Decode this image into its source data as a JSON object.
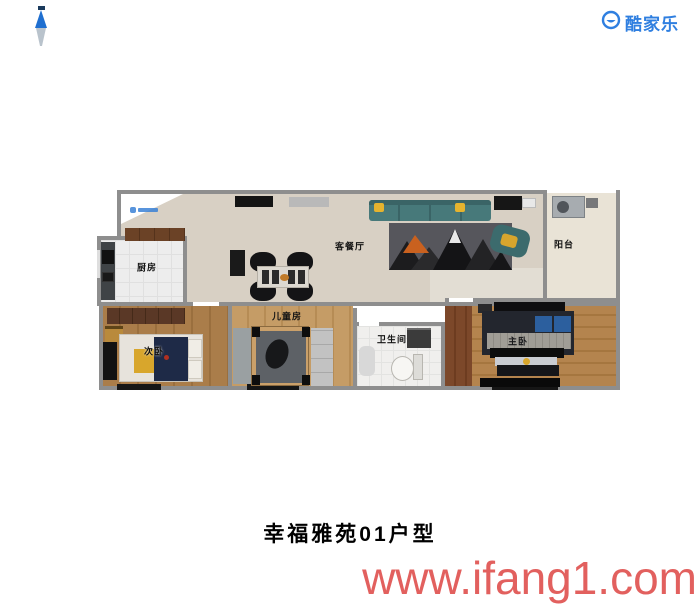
{
  "header": {
    "compass_icon": "north-compass",
    "logo": {
      "icon": "kujiale-smiley",
      "text": "酷家乐"
    }
  },
  "floor_plan": {
    "watermark_icon": "kujiale-mini-logo",
    "rooms": [
      {
        "id": "kitchen",
        "label": "厨房"
      },
      {
        "id": "living_dining",
        "label": "客餐厅"
      },
      {
        "id": "balcony",
        "label": "阳台"
      },
      {
        "id": "second_bedroom",
        "label": "次卧"
      },
      {
        "id": "kids_room",
        "label": "儿童房"
      },
      {
        "id": "bathroom",
        "label": "卫生间"
      },
      {
        "id": "master_bedroom",
        "label": "主卧"
      }
    ]
  },
  "footer": {
    "title": "幸福雅苑01户型",
    "watermark": "www.ifang1.com"
  },
  "colors": {
    "brand_blue": "#2f7fe0",
    "watermark_red": "#e2605e",
    "title_black": "#000000",
    "wall_gray": "#8e8e8e",
    "sofa_teal": "#47797a",
    "pillow_yellow": "#e5b32e",
    "bed_navy": "#1e2a47"
  }
}
